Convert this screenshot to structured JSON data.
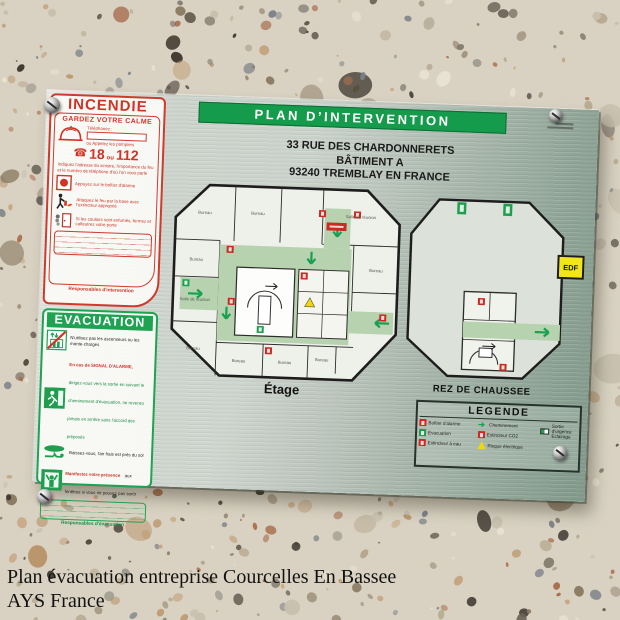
{
  "caption": {
    "line1": "Plan évacuation entreprise Courcelles En Bassee",
    "line2": "AYS France"
  },
  "plate": {
    "title": "PLAN D’INTERVENTION",
    "address_line1": "33 RUE DES CHARDONNERETS",
    "address_line2": "BÂTIMENT A",
    "address_line3": "93240 TREMBLAY EN FRANCE",
    "edf": "EDF"
  },
  "incendie": {
    "title": "INCENDIE",
    "keep_calm": "GARDEZ VOTRE CALME",
    "phone_label": "Téléphonez :",
    "call_firemen": "ou Appelez les pompiers",
    "number_1": "18",
    "number_or": "ou",
    "number_2": "112",
    "advice": "Indiquez l'adresse du sinistre, l'importance du feu et le numéro de téléphone d'où l'on vous parle",
    "step_alarm": "Appuyez sur le boîtier d'alarme",
    "step_extinguisher": "Attaquez le feu par la base avec l'extincteur approprié",
    "step_door": "Si les couloirs sont enfumés, fermez et calfeutrez votre porte",
    "footer": "Responsables d'intervention"
  },
  "evacuation": {
    "title": "EVACUATION",
    "step_lift": "N'utilisez pas les ascenseurs ou les monte-charges",
    "step_alarm_red": "En cas de SIGNAL D'ALARME,",
    "step_alarm_rest": "dirigez-vous vers la sortie en suivant le cheminement d'évacuation, ne revenez jamais en arrière sans l'accord des préposés",
    "step_crawl": "Baissez-vous, l'air frais est près du sol",
    "step_window_red": "Manifestez votre présence",
    "step_window_rest": "aux fenêtres si vous ne pouvez pas sortir",
    "footer": "Responsables d'évacuation"
  },
  "plan_etage": {
    "label": "Étage",
    "rooms": [
      "Bureau",
      "Bureau",
      "Salle de réunion",
      "Bureau",
      "Salle de réunion",
      "Bureau",
      "Bureau",
      "Bureau",
      "Bureau",
      "Bureau"
    ]
  },
  "plan_rdc": {
    "label": "REZ DE CHAUSSEE"
  },
  "legende": {
    "title": "LEGENDE",
    "items": [
      {
        "icon": "alarm-box-icon",
        "label": "Boîtier d'alarme"
      },
      {
        "icon": "evacuation-icon",
        "label": "Évacuation"
      },
      {
        "icon": "water-extinguisher-icon",
        "label": "Extincteur à eau"
      },
      {
        "icon": "path-arrow-icon",
        "label": "Cheminement"
      },
      {
        "icon": "co2-extinguisher-icon",
        "label": "Extincteur CO2"
      },
      {
        "icon": "electric-hazard-icon",
        "label": "Risque électrique"
      },
      {
        "icon": "emergency-light-icon",
        "label": "Sortie d'urgence Éclairage"
      }
    ]
  },
  "icons": {
    "phone": "☎",
    "arrow": "➔"
  },
  "colors": {
    "green": "#149c4c",
    "red": "#cf3a2c",
    "edf_yellow": "#f2e51c",
    "plate": "#bcc7be",
    "corridor": "#b6d2ae"
  }
}
